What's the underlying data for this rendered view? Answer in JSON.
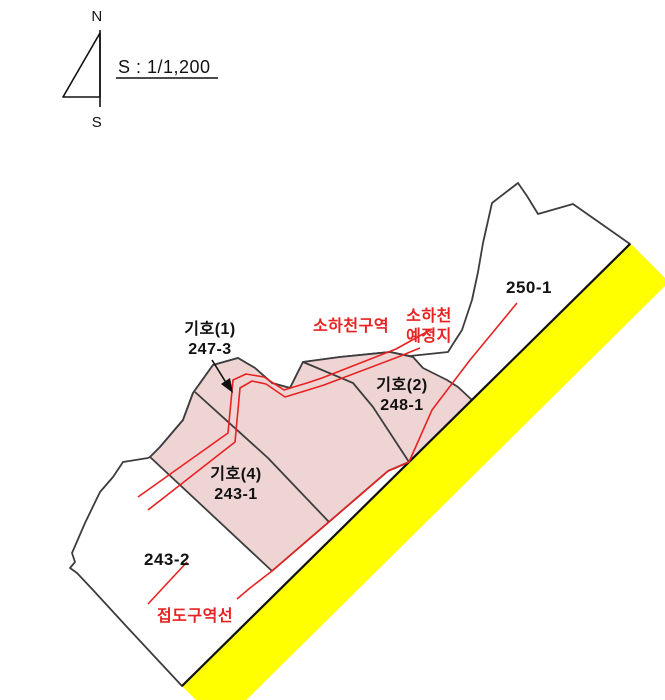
{
  "compass": {
    "north": "N",
    "south": "S"
  },
  "scale": {
    "text": "S : 1/1,200"
  },
  "colors": {
    "background": "#ffffff",
    "zone_fill": "#efd4d4",
    "road_fill": "#ffff00",
    "boundary": "#3d3d3d",
    "road_edge": "#111111",
    "red": "#e82222",
    "text": "#111111"
  },
  "shapes": {
    "road_band": [
      [
        630,
        243
      ],
      [
        669,
        282
      ],
      [
        221,
        725
      ],
      [
        182,
        686
      ]
    ],
    "road_edge_line": [
      [
        630,
        244
      ],
      [
        182,
        686
      ]
    ],
    "outer_boundary": [
      [
        150,
        457
      ],
      [
        160,
        447
      ],
      [
        183,
        420
      ],
      [
        193,
        393
      ],
      [
        213,
        365
      ],
      [
        238,
        358
      ],
      [
        255,
        368
      ],
      [
        272,
        383
      ],
      [
        290,
        388
      ],
      [
        303,
        362
      ],
      [
        340,
        357
      ],
      [
        390,
        352
      ],
      [
        410,
        356
      ],
      [
        448,
        352
      ],
      [
        453,
        344
      ],
      [
        462,
        330
      ],
      [
        472,
        300
      ],
      [
        478,
        272
      ],
      [
        483,
        243
      ],
      [
        492,
        203
      ],
      [
        518,
        183
      ],
      [
        527,
        196
      ],
      [
        538,
        214
      ],
      [
        573,
        204
      ],
      [
        630,
        244
      ],
      [
        182,
        686
      ],
      [
        127,
        627
      ],
      [
        93,
        590
      ],
      [
        77,
        573
      ],
      [
        70,
        568
      ],
      [
        75,
        562
      ],
      [
        72,
        553
      ],
      [
        85,
        523
      ],
      [
        100,
        492
      ],
      [
        113,
        477
      ],
      [
        123,
        462
      ],
      [
        148,
        458
      ]
    ],
    "zone_area": [
      [
        193,
        393
      ],
      [
        213,
        365
      ],
      [
        238,
        358
      ],
      [
        255,
        368
      ],
      [
        272,
        383
      ],
      [
        290,
        388
      ],
      [
        303,
        362
      ],
      [
        340,
        357
      ],
      [
        390,
        352
      ],
      [
        413,
        357
      ],
      [
        423,
        368
      ],
      [
        447,
        380
      ],
      [
        458,
        387
      ],
      [
        472,
        400
      ],
      [
        409,
        462
      ],
      [
        388,
        471
      ],
      [
        272,
        571
      ],
      [
        150,
        457
      ],
      [
        160,
        447
      ],
      [
        183,
        420
      ]
    ],
    "internal_boundaries": [
      {
        "name": "boundary-243-1-247-3",
        "points": [
          [
            195,
            392
          ],
          [
            268,
            458
          ],
          [
            329,
            522
          ]
        ]
      },
      {
        "name": "boundary-247-3-248-1",
        "points": [
          [
            303,
            362
          ],
          [
            353,
            383
          ],
          [
            373,
            407
          ],
          [
            390,
            433
          ],
          [
            409,
            462
          ]
        ]
      }
    ],
    "red_lines": [
      {
        "name": "stream-zone-line-a",
        "points": [
          [
            138,
            497
          ],
          [
            228,
            433
          ],
          [
            233,
            380
          ],
          [
            246,
            374
          ],
          [
            264,
            377
          ],
          [
            284,
            390
          ],
          [
            307,
            383
          ],
          [
            322,
            378
          ],
          [
            396,
            349
          ],
          [
            432,
            329
          ]
        ]
      },
      {
        "name": "stream-zone-line-b",
        "points": [
          [
            148,
            510
          ],
          [
            235,
            442
          ],
          [
            240,
            388
          ],
          [
            252,
            381
          ],
          [
            266,
            384
          ],
          [
            285,
            397
          ],
          [
            308,
            390
          ],
          [
            324,
            385
          ],
          [
            398,
            357
          ],
          [
            420,
            348
          ]
        ]
      },
      {
        "name": "road-zone-line",
        "points": [
          [
            517,
            303
          ],
          [
            470,
            360
          ],
          [
            432,
            410
          ],
          [
            409,
            462
          ],
          [
            388,
            471
          ],
          [
            272,
            571
          ],
          [
            250,
            588
          ],
          [
            237,
            599
          ]
        ]
      },
      {
        "name": "road-zone-line-sw",
        "points": [
          [
            187,
            562
          ],
          [
            148,
            604
          ]
        ]
      }
    ],
    "arrow": {
      "line": [
        [
          212,
          360
        ],
        [
          230,
          389
        ]
      ],
      "head": [
        [
          233,
          393
        ],
        [
          221,
          384
        ],
        [
          230,
          378
        ]
      ]
    },
    "compass": {
      "staff": [
        [
          100,
          30
        ],
        [
          100,
          107
        ]
      ],
      "triangle": [
        [
          100,
          33
        ],
        [
          63,
          97
        ],
        [
          100,
          97
        ]
      ]
    },
    "scale_underline": [
      [
        116,
        78
      ],
      [
        218,
        78
      ]
    ]
  },
  "labels": [
    {
      "name": "label-parcel-247-3",
      "lines": [
        "기호(1)",
        "247-3"
      ],
      "x": 210,
      "y": 334,
      "color": "text",
      "size": 16,
      "bold": true,
      "anchor": "middle"
    },
    {
      "name": "label-parcel-248-1",
      "lines": [
        "기호(2)",
        "248-1"
      ],
      "x": 402,
      "y": 390,
      "color": "text",
      "size": 16,
      "bold": true,
      "anchor": "middle"
    },
    {
      "name": "label-parcel-243-1",
      "lines": [
        "기호(4)",
        "243-1"
      ],
      "x": 236,
      "y": 479,
      "color": "text",
      "size": 16,
      "bold": true,
      "anchor": "middle"
    },
    {
      "name": "label-parcel-243-2",
      "lines": [
        "243-2"
      ],
      "x": 167,
      "y": 565,
      "color": "text",
      "size": 17,
      "bold": true,
      "anchor": "middle"
    },
    {
      "name": "label-parcel-250-1",
      "lines": [
        "250-1"
      ],
      "x": 529,
      "y": 293,
      "color": "text",
      "size": 17,
      "bold": true,
      "anchor": "middle"
    },
    {
      "name": "label-stream-zone",
      "lines": [
        "소하천구역"
      ],
      "x": 351,
      "y": 331,
      "color": "red",
      "size": 16,
      "bold": true,
      "anchor": "middle"
    },
    {
      "name": "label-stream-planned",
      "lines": [
        "소하천",
        "예정지"
      ],
      "x": 429,
      "y": 321,
      "color": "red",
      "size": 16,
      "bold": true,
      "anchor": "middle"
    },
    {
      "name": "label-road-zone",
      "lines": [
        "접도구역선"
      ],
      "x": 195,
      "y": 621,
      "color": "red",
      "size": 16,
      "bold": true,
      "anchor": "middle"
    },
    {
      "name": "compass-north-label",
      "lines": [
        "N"
      ],
      "x": 97,
      "y": 21,
      "color": "text",
      "size": 15,
      "bold": false,
      "anchor": "middle"
    },
    {
      "name": "compass-south-label",
      "lines": [
        "S"
      ],
      "x": 97,
      "y": 127,
      "color": "text",
      "size": 15,
      "bold": false,
      "anchor": "middle"
    },
    {
      "name": "scale-text",
      "lines": [
        "S : 1/1,200"
      ],
      "x": 118,
      "y": 73,
      "color": "text",
      "size": 18,
      "bold": false,
      "anchor": "start"
    }
  ]
}
